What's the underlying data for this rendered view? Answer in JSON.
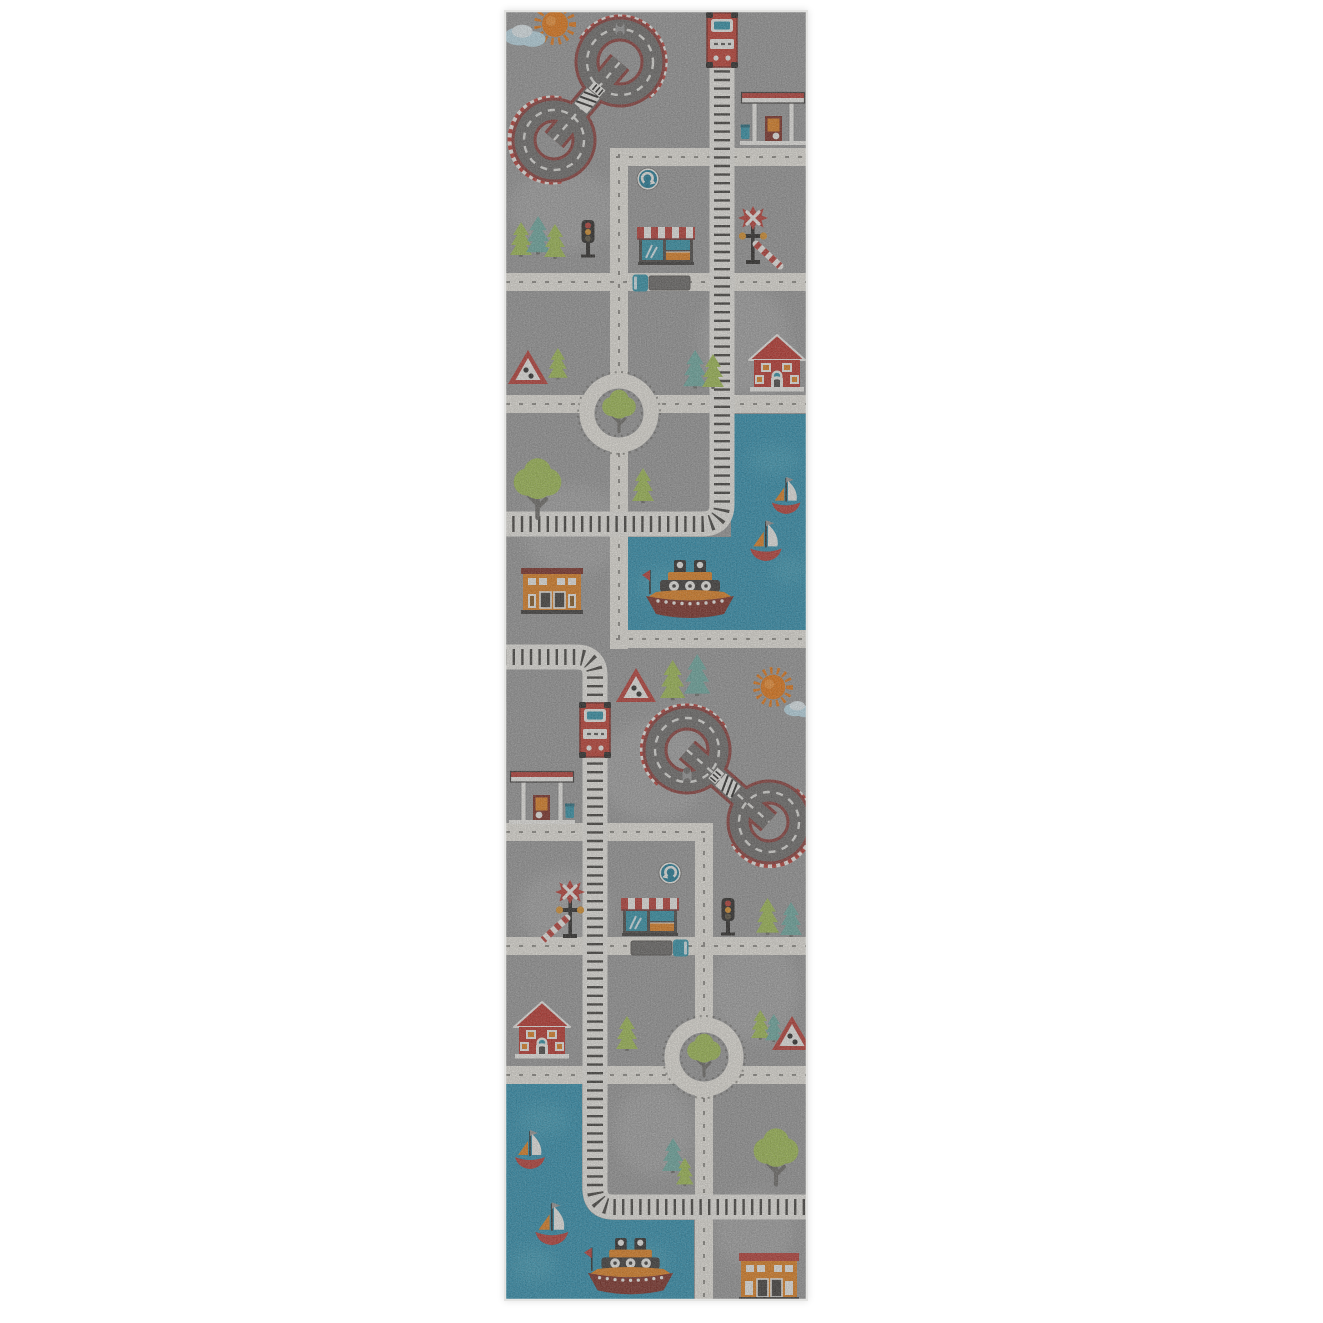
{
  "page": {
    "background": "#ffffff"
  },
  "rug": {
    "type": "kids-road-play-rug-runner",
    "areas": [
      "city-road-grid",
      "harbor-water",
      "figure-eight-racetrack",
      "railway-line"
    ],
    "object_counts": {
      "racetracks": 2,
      "roundabouts": 2,
      "train_engines": 2,
      "railway_lines": 2,
      "sailboats": 4,
      "ferry_boats": 2,
      "red_houses": 2,
      "shops_with_awning": 2,
      "gas_stations": 2,
      "orange_buildings": 2,
      "suns": 2,
      "clouds": 2,
      "warning_triangles": 3,
      "roundabout_signs": 2,
      "railroad_crossings": 2,
      "traffic_lights": 2,
      "trucks": 2,
      "pine_trees": 14,
      "round_trees": 4
    }
  },
  "palette": {
    "rug": "#9d9d9d",
    "rug_light": "#b9b9b9",
    "road": "#f2efe7",
    "road_mark": "#5f5d58",
    "water": "#2d93b4",
    "water_light": "#55b4ca",
    "track_bed": "#f4f2ec",
    "tie": "#2d2b28",
    "asphalt": "#6f6d6b",
    "track_edge": "#8e3a36",
    "checker_red": "#bf3a32",
    "white": "#f8f7f3",
    "red": "#c23128",
    "dark_red": "#7e2a20",
    "train_red": "#c63b2e",
    "orange": "#e8821c",
    "green": "#a4c352",
    "teal_tree": "#6fb0a6",
    "trunk": "#6e6c68",
    "dark": "#2b2927",
    "teal": "#2f96ae",
    "sun": "#f0790f",
    "cloud": "#c2e3f0",
    "sign_blue": "#1d7e9c",
    "amber": "#e29427",
    "binding": "#e3e3e1"
  }
}
